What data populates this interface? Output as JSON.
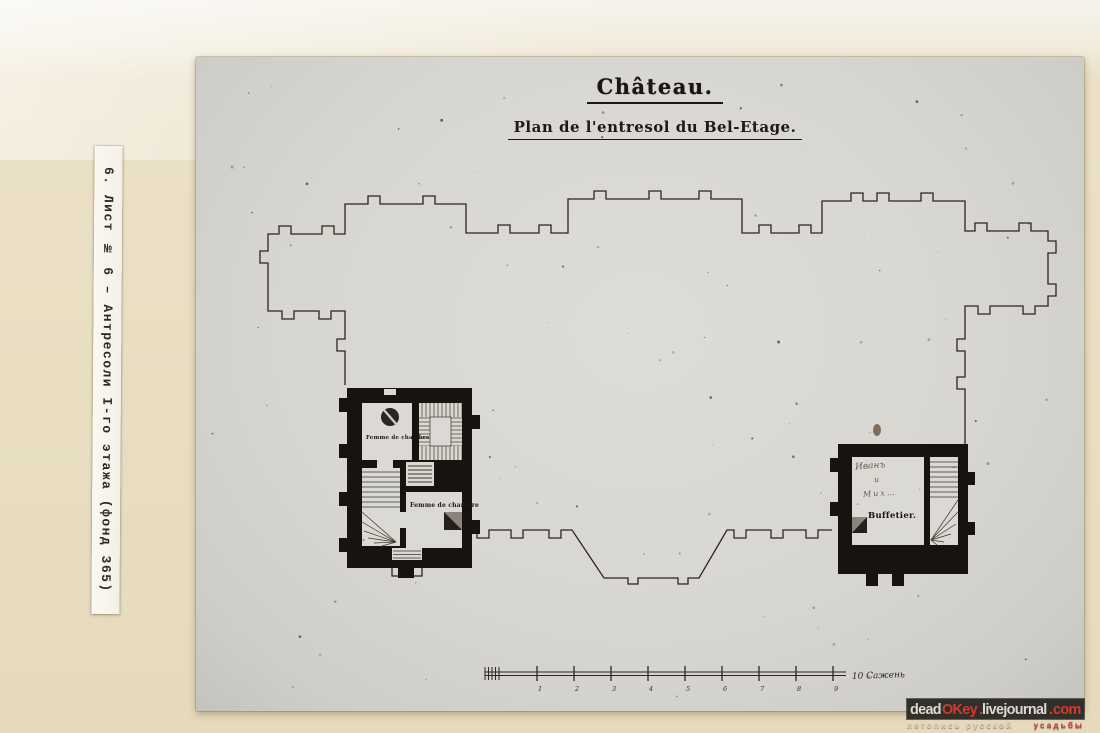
{
  "album": {
    "side_label": "6. Лист № 6 – Антресоли I-го этажа (фонд 365)"
  },
  "drawing": {
    "title": "Château.",
    "subtitle": "Plan de l'entresol du Bel-Etage.",
    "labels": {
      "left_room_upper": "Femme de chambre",
      "left_room_lower": "Femme de chambre",
      "right_room": "Buffetier.",
      "right_room_handwritten": [
        "Иванъ",
        "и",
        "Мих…"
      ]
    },
    "scale": {
      "tick_labels": [
        "1",
        "2",
        "3",
        "4",
        "5",
        "6",
        "7",
        "8",
        "9"
      ],
      "end_label": "10 Сажень"
    }
  },
  "watermark": {
    "domain_segments": [
      {
        "text": "dead",
        "color": "#ddd9d0"
      },
      {
        "text": "OKey",
        "color": "#d63a2c"
      },
      {
        "text": ".",
        "color": "#d63a2c"
      },
      {
        "text": "livejournal",
        "color": "#ddd9d0"
      },
      {
        "text": ".",
        "color": "#d63a2c"
      },
      {
        "text": "com",
        "color": "#d63a2c"
      }
    ],
    "tagline": [
      {
        "text": "летопись русской",
        "color": "#d9d4c8"
      },
      {
        "text": "усадьбы",
        "color": "#cc3326"
      }
    ]
  },
  "colors": {
    "album_page": "#e9dec2",
    "photo_print": "#d8d6d1",
    "drawing_ink": "#23201c",
    "watermark_red": "#d63a2c",
    "watermark_bar": "#262421"
  }
}
